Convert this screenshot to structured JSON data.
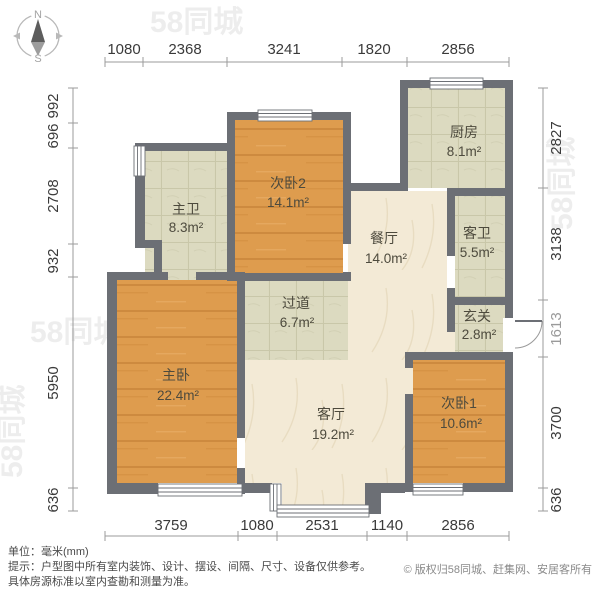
{
  "compass": {
    "north": "N",
    "south": "S"
  },
  "dimensions": {
    "unit": "mm",
    "top": [
      "1080",
      "2368",
      "3241",
      "1820",
      "2856"
    ],
    "bottom": [
      "3759",
      "1080",
      "2531",
      "1140",
      "2856"
    ],
    "left": [
      "992",
      "696",
      "2708",
      "932",
      "5950",
      "636"
    ],
    "right": [
      "2827",
      "3138",
      "1613",
      "3700",
      "636"
    ]
  },
  "rooms": {
    "master_bath": {
      "name": "主卫",
      "area": "8.3m²"
    },
    "bedroom2": {
      "name": "次卧2",
      "area": "14.1m²"
    },
    "kitchen": {
      "name": "厨房",
      "area": "8.1m²"
    },
    "guest_bath": {
      "name": "客卫",
      "area": "5.5m²"
    },
    "dining": {
      "name": "餐厅",
      "area": "14.0m²"
    },
    "hallway": {
      "name": "过道",
      "area": "6.7m²"
    },
    "entry": {
      "name": "玄关",
      "area": "2.8m²"
    },
    "master_bedroom": {
      "name": "主卧",
      "area": "22.4m²"
    },
    "living": {
      "name": "客厅",
      "area": "19.2m²"
    },
    "bedroom1": {
      "name": "次卧1",
      "area": "10.6m²"
    }
  },
  "footer": {
    "unit_label": "单位：毫米(mm)",
    "tip_line1": "提示：户型图中所有室内装饰、设计、摆设、间隔、尺寸、设备仅供参考。",
    "tip_line2": "具体房源标准以室内查勘和测量为准。",
    "copyright": "© 版权归58同城、赶集网、安居客所有"
  },
  "watermark": {
    "text": "58同城"
  },
  "colors": {
    "wall": "#6c6f75",
    "wood_floor": "#de9c4e",
    "tile_floor": "#dcdac0",
    "marble_floor": "#f3ead6",
    "dimension_text": "#3a3a3a"
  }
}
